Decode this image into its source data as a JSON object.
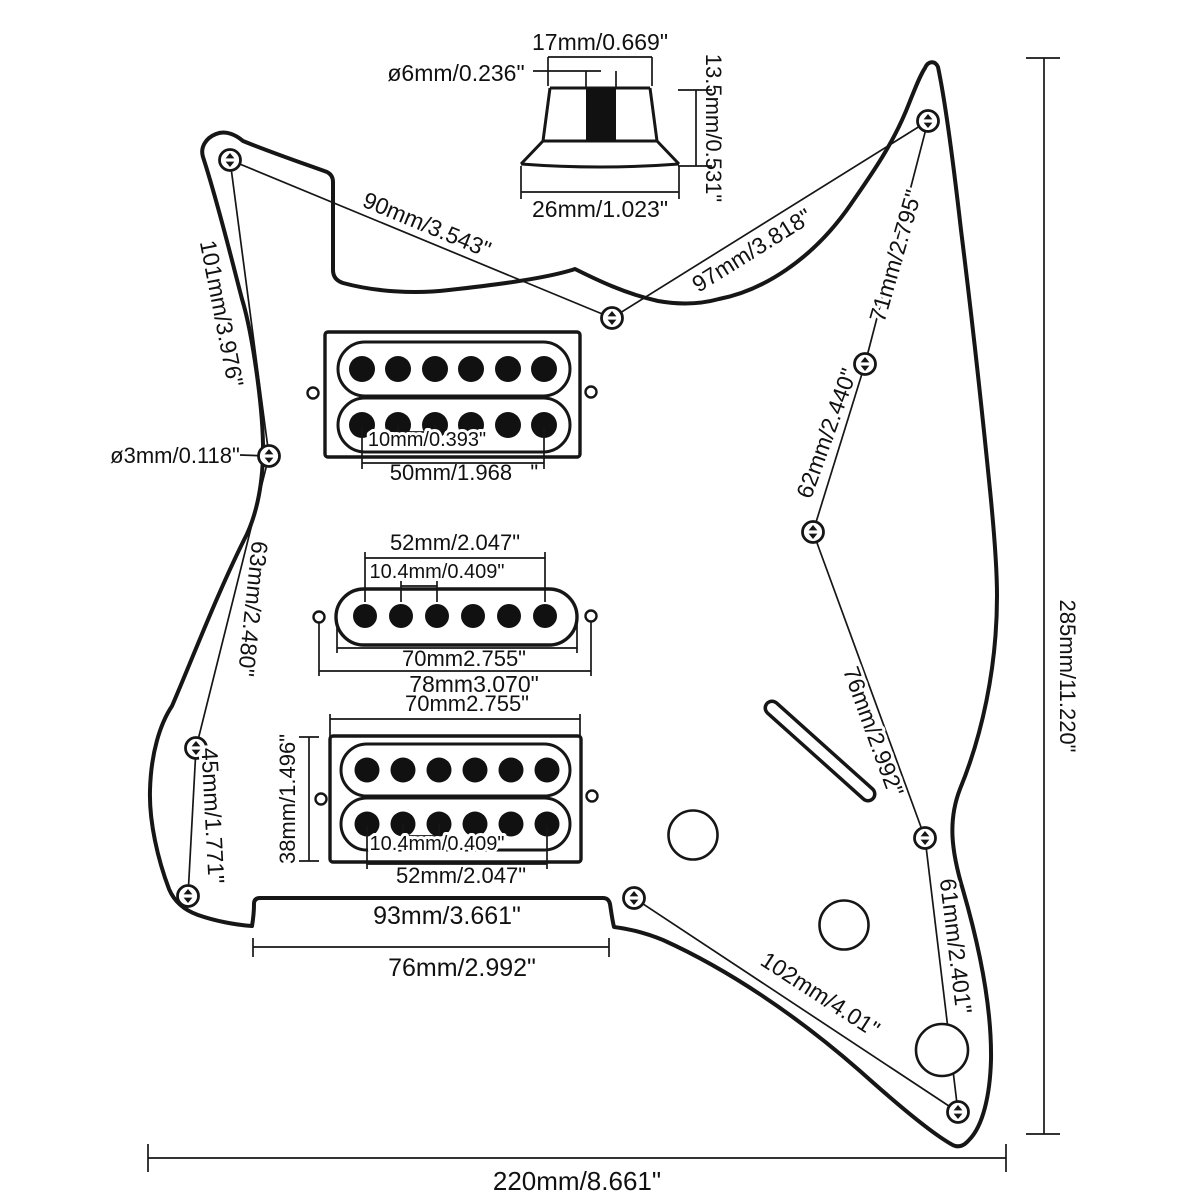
{
  "knob": {
    "top_width": "17mm/0.669\"",
    "shaft_diameter": "ø6mm/0.236\"",
    "height": "13.5mm/0.531\"",
    "base_width": "26mm/1.023\""
  },
  "screw_spacing": {
    "s90": "90mm/3.543\"",
    "s97": "97mm/3.818\"",
    "s101": "101mm/3.976\"",
    "s71": "71mm/2.795\"",
    "s62": "62mm/2.440\"",
    "s76_right": "76mm/2.992\"",
    "s61": "61mm/2.401\"",
    "s102": "102mm/4.01\"",
    "s63": "63mm/2.480\"",
    "s45": "45mm/1.771\"",
    "hole_diameter": "ø3mm/0.118\""
  },
  "neck_humbucker": {
    "pole_spacing": "10mm/0.393\"",
    "pole_span": "50mm/1.968   \""
  },
  "middle_pickup": {
    "pole_span": "52mm/2.047\"",
    "pole_spacing": "10.4mm/0.409\"",
    "body_width": "70mm2.755\"",
    "mount_span": "78mm3.070\""
  },
  "bridge_humbucker": {
    "body_width": "70mm2.755\"",
    "height": "38mm/1.496\"",
    "pole_spacing": "10.4mm/0.409\"",
    "pole_span": "52mm/2.047\""
  },
  "neck_pocket": {
    "width": "93mm/3.661\"",
    "screw_span": "76mm/2.992\""
  },
  "overall": {
    "height": "285mm/11.220\"",
    "width": "220mm/8.661\""
  }
}
